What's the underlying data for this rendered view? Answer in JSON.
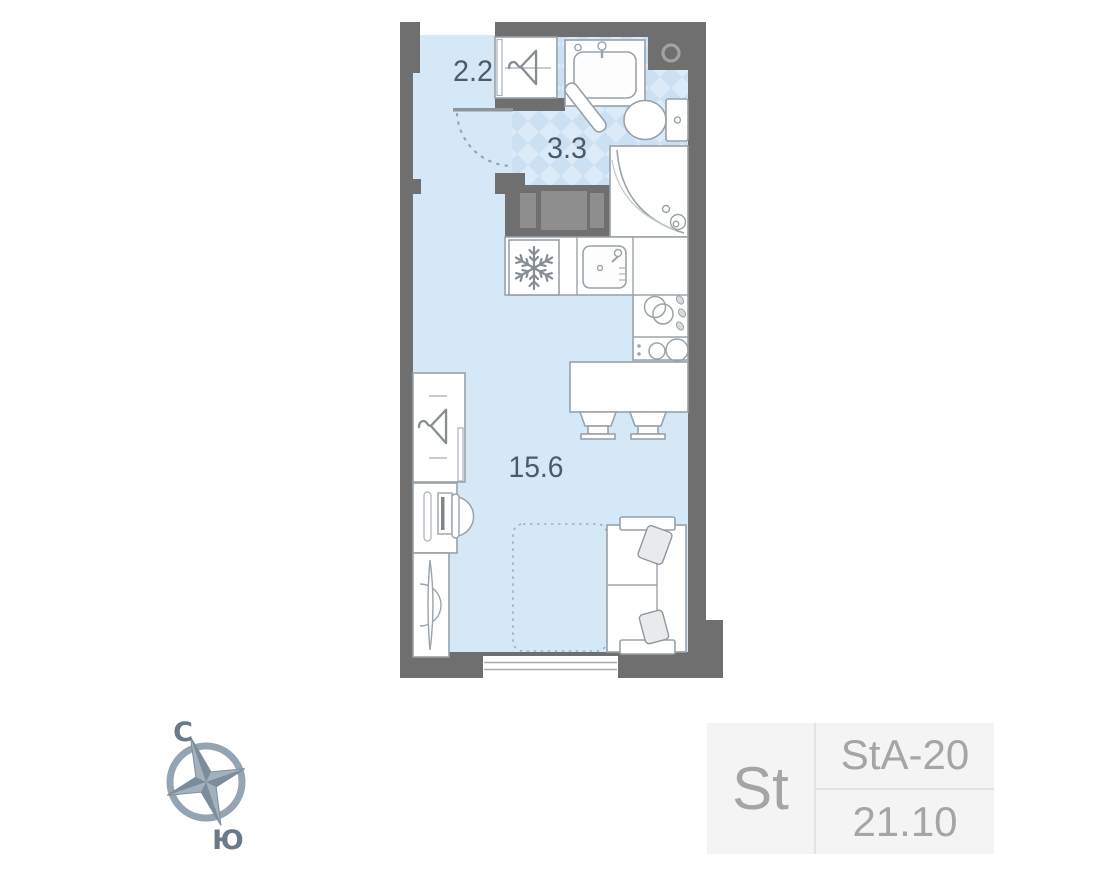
{
  "floor_plan": {
    "rooms": [
      {
        "id": "hallway",
        "area_label": "2.2"
      },
      {
        "id": "bathroom",
        "area_label": "3.3"
      },
      {
        "id": "living-room",
        "area_label": "15.6"
      }
    ],
    "icons": [
      "hanger-icon",
      "snowflake-fridge-icon",
      "kitchen-sink-icon",
      "bathroom-sink-icon",
      "toilet-icon",
      "corner-shower-icon",
      "cooktop-icon",
      "washer-icon",
      "vent-shaft-icon",
      "door-swing-arc",
      "bed-outline",
      "sofa-icon",
      "desk-chair-icon",
      "tv-console-icon"
    ],
    "colors": {
      "wall": "#6f6f6f",
      "floor": "#d5e8f8",
      "tile_light": "#dcebfa",
      "tile_dark": "#cbe0f3",
      "outline": "#98a1a8",
      "room_label": "#4e5a66",
      "storage_panel": "#8e8e8e"
    }
  },
  "compass": {
    "north_label": "С",
    "south_label": "Ю",
    "color": "#8b9cac"
  },
  "unit_card": {
    "type_label": "St",
    "code": "StA-20",
    "area": "21.10",
    "bg": "#f4f4f5",
    "text_color": "#a5a5a8"
  }
}
